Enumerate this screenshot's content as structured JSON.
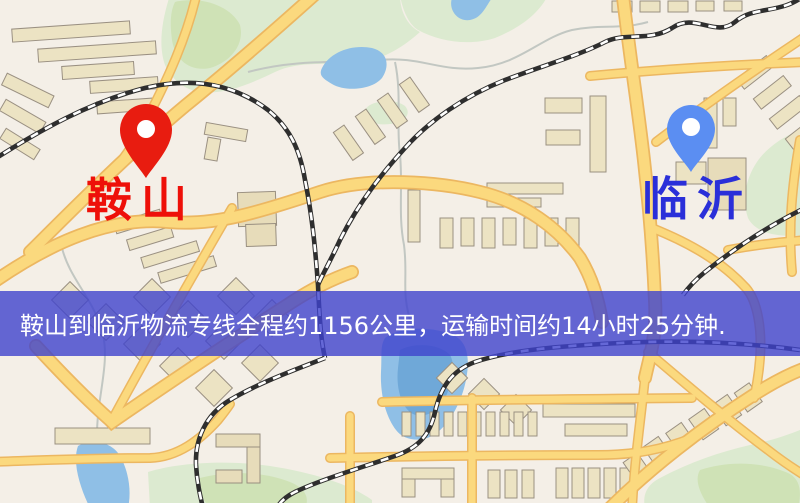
{
  "banner": {
    "text": "鞍山到临沂物流专线全程约1156公里，运输时间约14小时25分钟.",
    "bg_color": "#3e42cd",
    "text_color": "#ffffff"
  },
  "markers": {
    "origin": {
      "label": "鞍山",
      "pin_color": "#e81c10",
      "pin_hole_color": "#ffffff",
      "label_color": "#ee1009"
    },
    "destination": {
      "label": "临沂",
      "pin_color": "#5b8ef2",
      "pin_hole_color": "#ffffff",
      "label_color": "#2a2fd9"
    }
  },
  "map": {
    "palette": {
      "background": "#f4efe7",
      "road_fill": "#fbd97e",
      "road_casing": "#ecb761",
      "building": "#ece3c3",
      "park_green": "#dcead0",
      "water_blue": "#8fbfe6",
      "railway_dark": "#2e2e2e",
      "railway_dash": "#ffffff"
    }
  }
}
